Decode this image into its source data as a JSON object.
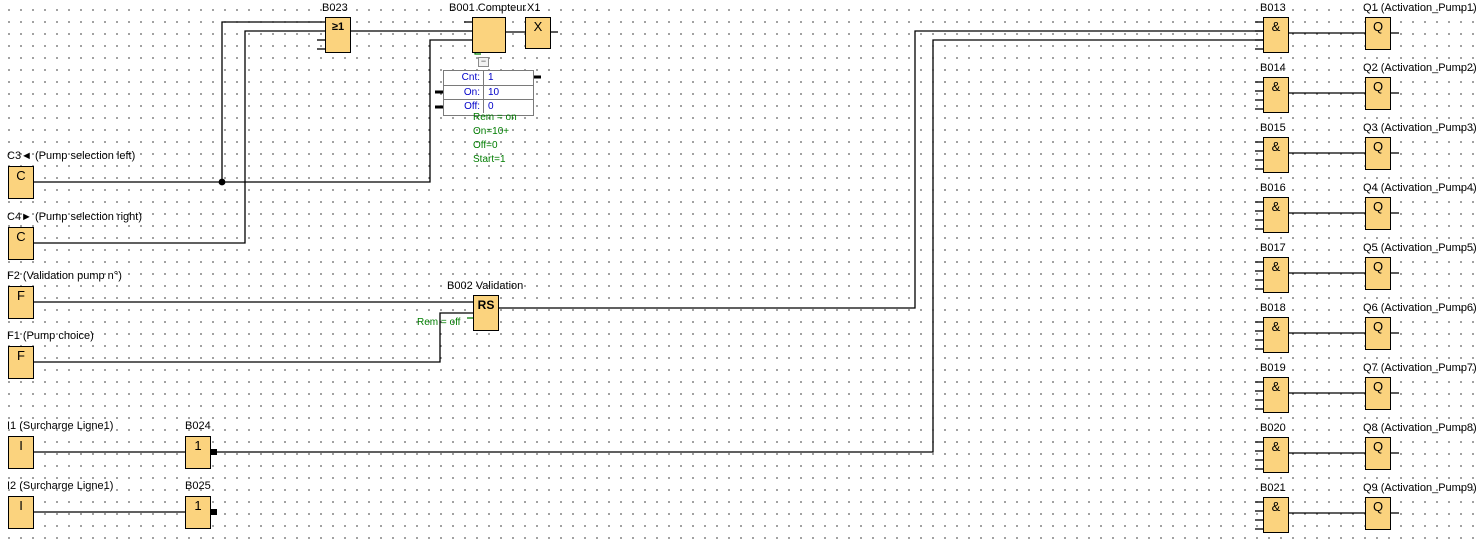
{
  "colors": {
    "canvas_bg": "#FFFFFF",
    "grid_dot": "#4D4D4D",
    "block_fill": "#FBD37E",
    "block_border": "#000000",
    "wire": "#000000",
    "param_text": "#0000C8",
    "param_border": "#7A7A7A",
    "annotation_green": "#007D00"
  },
  "left_inputs": [
    {
      "id": "C3",
      "symbol": "C",
      "label": "C3◄ (Pump selection left)"
    },
    {
      "id": "C4",
      "symbol": "C",
      "label": "C4► (Pump selection right)"
    },
    {
      "id": "F2",
      "symbol": "F",
      "label": "F2 (Validation pump n°)"
    },
    {
      "id": "F1",
      "symbol": "F",
      "label": "F1 (Pump choice)"
    },
    {
      "id": "I1",
      "symbol": "I",
      "label": "I1 (Surcharge Ligne1)"
    },
    {
      "id": "I2",
      "symbol": "I",
      "label": "I2 (Surcharge Ligne1)"
    }
  ],
  "middle_blocks": {
    "or_gate": {
      "label": "B023",
      "symbol": "≥1"
    },
    "counter": {
      "label": "B001 Compteur",
      "plus_minus": "+/-"
    },
    "x_ref": {
      "label": "X1",
      "symbol": "X"
    },
    "rs": {
      "label": "B002 Validation",
      "symbol": "RS",
      "annotation": "Rem = off"
    },
    "not1": {
      "label": "B024",
      "symbol": "1"
    },
    "not2": {
      "label": "B025",
      "symbol": "1"
    }
  },
  "counter_panel": {
    "collapse_glyph": "−",
    "params": [
      {
        "label": "Cnt:",
        "value": "1"
      },
      {
        "label": "On:",
        "value": "10"
      },
      {
        "label": "Off:",
        "value": "0"
      }
    ],
    "annotations": [
      "Rem = on",
      "On=10+",
      "Off=0",
      "Start=1"
    ]
  },
  "output_rows": [
    {
      "gate": "B013",
      "symbol": "&",
      "q_symbol": "Q",
      "q_label": "Q1 (Activation_Pump1)"
    },
    {
      "gate": "B014",
      "symbol": "&",
      "q_symbol": "Q",
      "q_label": "Q2 (Activation_Pump2)"
    },
    {
      "gate": "B015",
      "symbol": "&",
      "q_symbol": "Q",
      "q_label": "Q3 (Activation_Pump3)"
    },
    {
      "gate": "B016",
      "symbol": "&",
      "q_symbol": "Q",
      "q_label": "Q4 (Activation_Pump4)"
    },
    {
      "gate": "B017",
      "symbol": "&",
      "q_symbol": "Q",
      "q_label": "Q5 (Activation_Pump5)"
    },
    {
      "gate": "B018",
      "symbol": "&",
      "q_symbol": "Q",
      "q_label": "Q6 (Activation_Pump6)"
    },
    {
      "gate": "B019",
      "symbol": "&",
      "q_symbol": "Q",
      "q_label": "Q7 (Activation_Pump7)"
    },
    {
      "gate": "B020",
      "symbol": "&",
      "q_symbol": "Q",
      "q_label": "Q8 (Activation_Pump8)"
    },
    {
      "gate": "B021",
      "symbol": "&",
      "q_symbol": "Q",
      "q_label": "Q9 (Activation_Pump9)"
    }
  ]
}
